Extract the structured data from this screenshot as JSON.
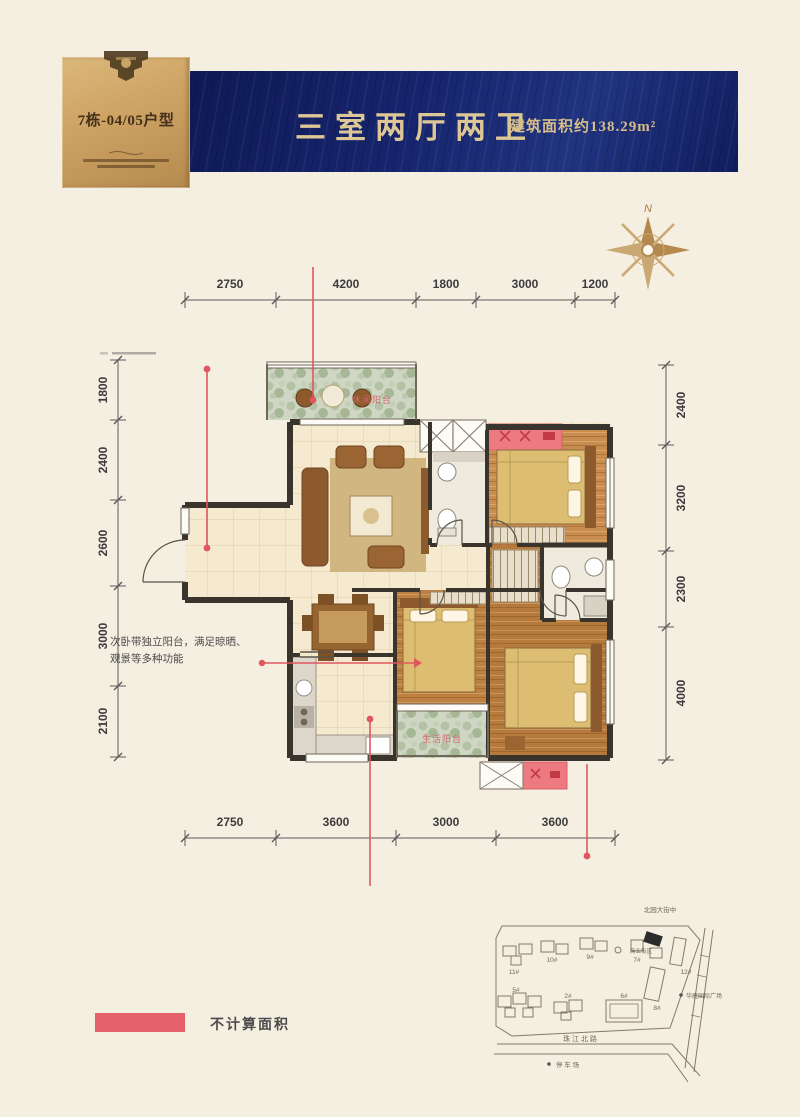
{
  "header": {
    "unit_label": "7栋-04/05户型",
    "title": "三室两厅两卫",
    "area": "建筑面积约138.29m²"
  },
  "compass": {
    "label": "N"
  },
  "dims": {
    "top": [
      "2750",
      "4200",
      "1800",
      "3000",
      "1200"
    ],
    "bottom": [
      "2750",
      "3600",
      "3000",
      "3600"
    ],
    "left": [
      "1800",
      "2400",
      "2600",
      "3000",
      "2100"
    ],
    "right": [
      "2400",
      "3200",
      "2300",
      "4000"
    ]
  },
  "floorplan": {
    "balcony_top_label": "休闲阳台",
    "balcony_bottom_label": "生活阳台",
    "annotation_line1": "次卧带独立阳台，满足晾晒、",
    "annotation_line2": "观景等多种功能"
  },
  "legend": {
    "label": "不计算面积",
    "swatch_color": "#e4606a"
  },
  "sitemap": {
    "road_top": "北园大街中",
    "road_bottom": "珠 江 北 路",
    "poi_right": "华庭国际广场",
    "poi_center": "商业街区",
    "poi_bottom": "停 车 场",
    "buildings": [
      "11#",
      "10#",
      "9#",
      "7#",
      "12#",
      "8#",
      "5#",
      "2#",
      "6#"
    ],
    "highlighted": "7#"
  },
  "colors": {
    "navy": "#16246d",
    "gold": "#c8a566",
    "red_line": "#e0565e",
    "not_counted": "#ec7a80",
    "wood": "#c08448",
    "tile": "#f5ead0"
  }
}
